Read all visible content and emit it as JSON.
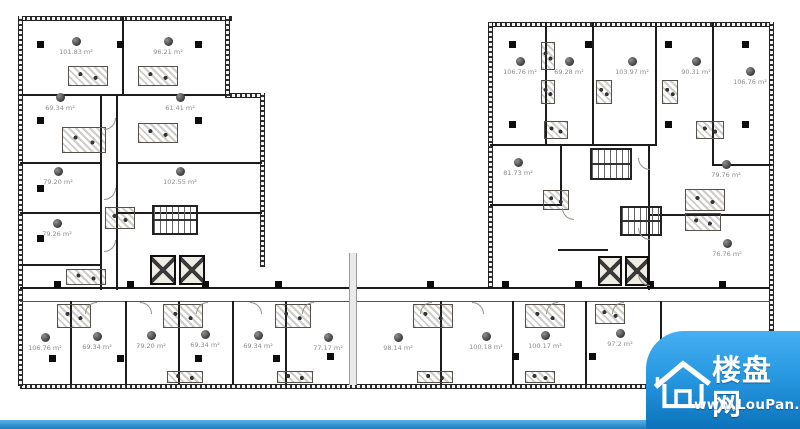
{
  "watermark": {
    "brand": "楼盘网",
    "url": "www.LouPan.com",
    "colors": {
      "panel_top": "#46aff2",
      "panel_bottom": "#0d73ba",
      "bottom_bar": "#2a8ed4",
      "text": "#ffffff"
    }
  },
  "floor_plan": {
    "area_unit": "m²",
    "rooms": [
      {
        "area": "101.83 m²",
        "x": 76,
        "y": 42
      },
      {
        "area": "96.21 m²",
        "x": 168,
        "y": 42
      },
      {
        "area": "69.34 m²",
        "x": 60,
        "y": 98
      },
      {
        "area": "61.41 m²",
        "x": 180,
        "y": 98
      },
      {
        "area": "79.20 m²",
        "x": 58,
        "y": 172
      },
      {
        "area": "102.55 m²",
        "x": 180,
        "y": 172
      },
      {
        "area": "79.26 m²",
        "x": 57,
        "y": 224
      },
      {
        "area": "106.76 m²",
        "x": 45,
        "y": 338
      },
      {
        "area": "69.34 m²",
        "x": 97,
        "y": 337
      },
      {
        "area": "79.20 m²",
        "x": 151,
        "y": 336
      },
      {
        "area": "69.34 m²",
        "x": 205,
        "y": 335
      },
      {
        "area": "69.34 m²",
        "x": 258,
        "y": 336
      },
      {
        "area": "77.17 m²",
        "x": 328,
        "y": 338
      },
      {
        "area": "98.14 m²",
        "x": 398,
        "y": 338
      },
      {
        "area": "100.18 m²",
        "x": 486,
        "y": 337
      },
      {
        "area": "100.17 m²",
        "x": 545,
        "y": 336
      },
      {
        "area": "97.2 m²",
        "x": 620,
        "y": 334
      },
      {
        "area": "106.76 m²",
        "x": 520,
        "y": 62
      },
      {
        "area": "69.28 m²",
        "x": 569,
        "y": 62
      },
      {
        "area": "103.97 m²",
        "x": 632,
        "y": 62
      },
      {
        "area": "90.31 m²",
        "x": 696,
        "y": 62
      },
      {
        "area": "106.76 m²",
        "x": 750,
        "y": 72
      },
      {
        "area": "81.73 m²",
        "x": 518,
        "y": 163
      },
      {
        "area": "79.76 m²",
        "x": 726,
        "y": 165
      },
      {
        "area": "76.76 m²",
        "x": 727,
        "y": 244
      }
    ]
  }
}
